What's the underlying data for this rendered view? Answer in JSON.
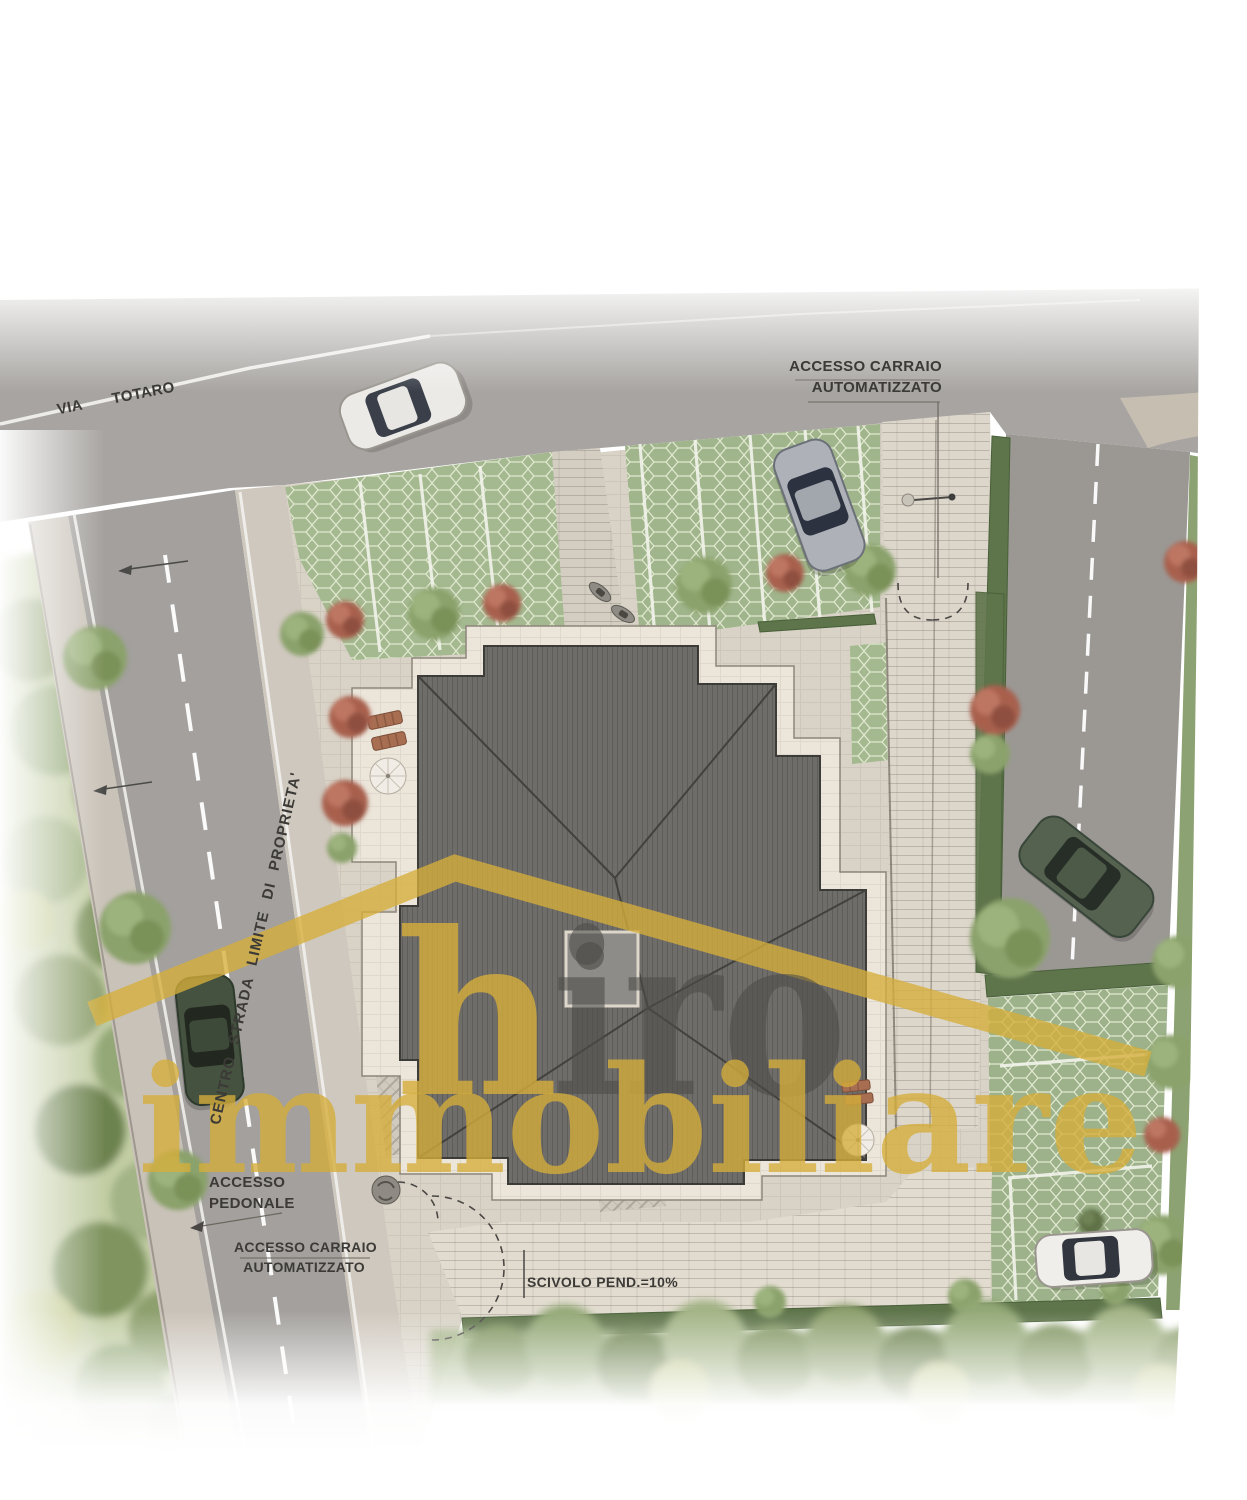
{
  "labels": {
    "street": {
      "word1": "VIA",
      "word2": "TOTARO"
    },
    "access_gate_top": {
      "line1": "ACCESSO CARRAIO",
      "line2": "AUTOMATIZZATO"
    },
    "property_boundary": "CENTRO STRADA LIMITE DI PROPRIETA'",
    "pedestrian_access": {
      "line1": "ACCESSO",
      "line2": "PEDONALE"
    },
    "access_gate_bottom": {
      "line1": "ACCESSO CARRAIO",
      "line2": "AUTOMATIZZATO"
    },
    "ramp": "SCIVOLO PEND.=10%"
  },
  "watermark": {
    "h": "h",
    "iro": "iro",
    "word": "immobiliare"
  },
  "colors": {
    "watermark_gold": "#d6ae3a",
    "watermark_gray": "#4e4c49",
    "asphalt": "#a4a19e",
    "roof": "#6f6d6a",
    "terrace": "#ebe5da",
    "grass_pavers": "#a5b990",
    "hedge": "#5e744a",
    "label_text": "#3c3a37"
  }
}
